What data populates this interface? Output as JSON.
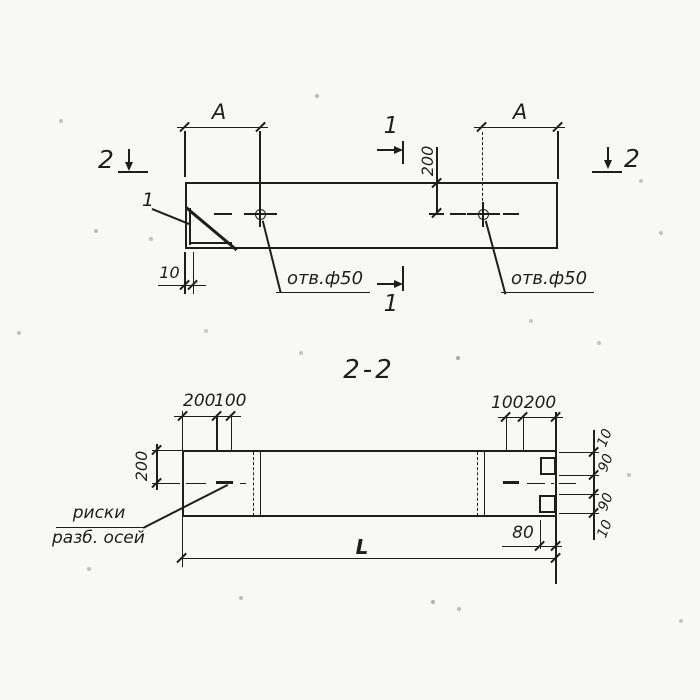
{
  "colors": {
    "ink": "#1e1e1c",
    "paper": "#f8f8f5"
  },
  "plan": {
    "dim_a_left": "A",
    "dim_a_right": "A",
    "dim_200": "200",
    "dim_10": "10",
    "hole_label_left": "отв.ф50",
    "hole_label_right": "отв.ф50",
    "marker_2_left": "2",
    "marker_2_right": "2",
    "marker_1_top": "1",
    "marker_1_bottom": "1",
    "corner_detail_label": "1"
  },
  "section": {
    "title": "2-2",
    "top_left_dims": [
      "200",
      "100"
    ],
    "top_right_dims": [
      "100",
      "200"
    ],
    "left_height_dim": "200",
    "right_chain_dims": [
      "10",
      "90",
      "90",
      "10"
    ],
    "length_dim": "L",
    "offset_dim": "80",
    "axis_marks_label": [
      "риски",
      "разб. осей"
    ]
  }
}
